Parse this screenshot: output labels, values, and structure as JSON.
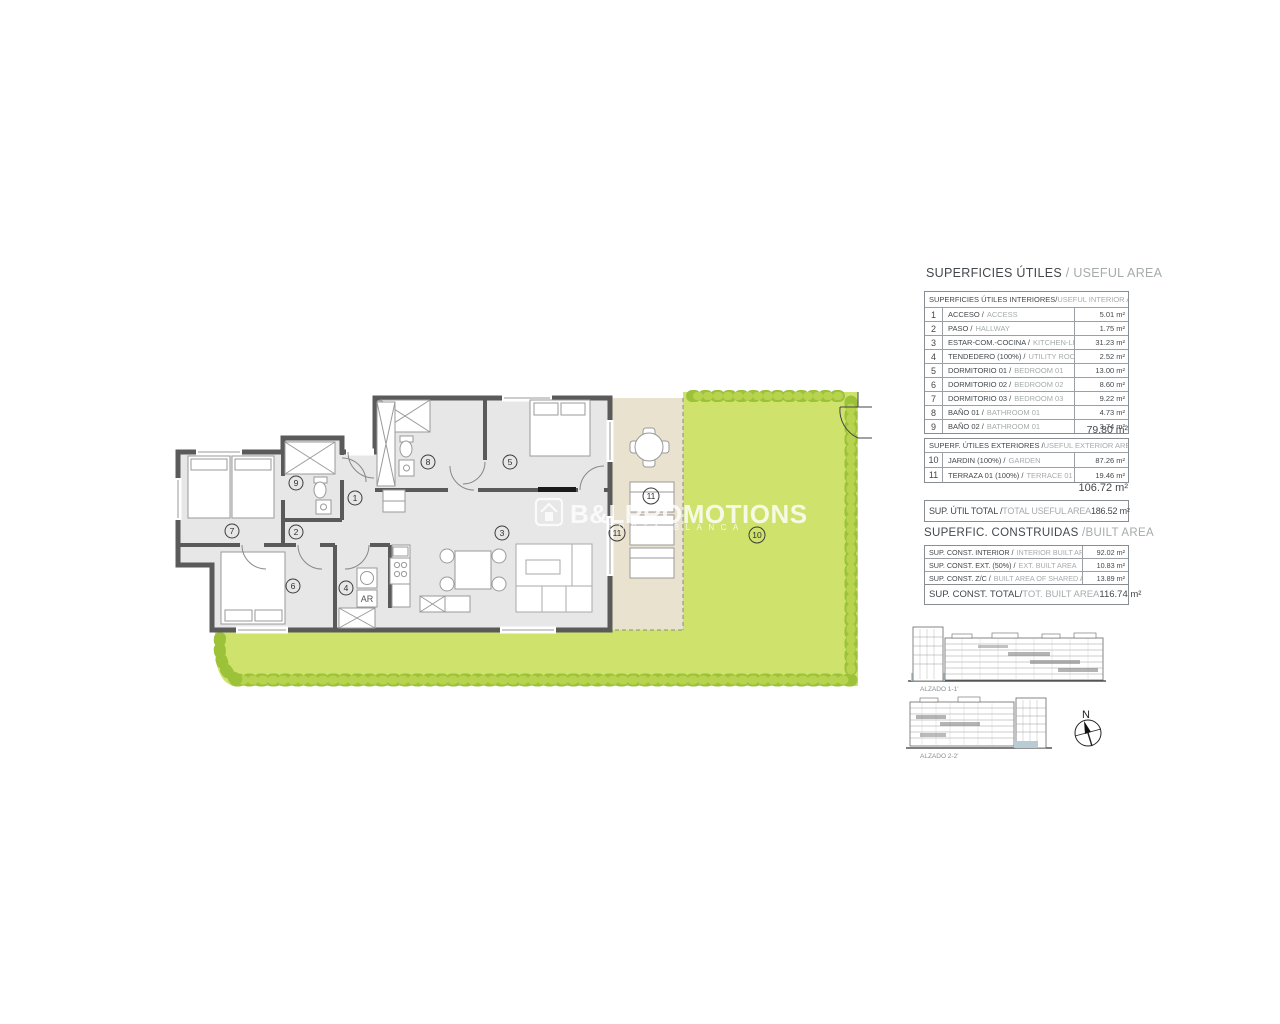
{
  "useful_area": {
    "title_es": "SUPERFICIES ÚTILES",
    "title_en": " / USEFUL AREA",
    "interior": {
      "header_es": "SUPERFICIES ÚTILES INTERIORES/",
      "header_en": " USEFUL INTERIOR AREA",
      "rows": [
        {
          "num": "1",
          "es": "ACCESO /",
          "en": "ACCESS",
          "val": "5.01 m²"
        },
        {
          "num": "2",
          "es": "PASO /",
          "en": "HALLWAY",
          "val": "1.75 m²"
        },
        {
          "num": "3",
          "es": "ESTAR-COM.-COCINA /",
          "en": "KITCHEN-LIVING",
          "val": "31.23 m²"
        },
        {
          "num": "4",
          "es": "TENDEDERO (100%) /",
          "en": "UTILITY ROOM",
          "val": "2.52 m²"
        },
        {
          "num": "5",
          "es": "DORMITORIO 01 /",
          "en": "BEDROOM 01",
          "val": "13.00 m²"
        },
        {
          "num": "6",
          "es": "DORMITORIO 02 /",
          "en": "BEDROOM 02",
          "val": "8.60 m²"
        },
        {
          "num": "7",
          "es": "DORMITORIO 03 /",
          "en": "BEDROOM 03",
          "val": "9.22 m²"
        },
        {
          "num": "8",
          "es": "BAÑO 01 /",
          "en": "BATHROOM 01",
          "val": "4.73 m²"
        },
        {
          "num": "9",
          "es": "BAÑO 02 /",
          "en": "BATHROOM 01",
          "val": "3.74 m²"
        }
      ],
      "subtotal": "79.80 m²"
    },
    "exterior": {
      "header_es": "SUPERF. ÚTILES EXTERIORES /",
      "header_en": " USEFUL EXTERIOR AREA",
      "rows": [
        {
          "num": "10",
          "es": "JARDIN (100%) /",
          "en": "GARDEN",
          "val": "87.26 m²"
        },
        {
          "num": "11",
          "es": "TERRAZA 01 (100%) /",
          "en": "TERRACE 01",
          "val": "19.46 m²"
        }
      ],
      "subtotal": "106.72 m²",
      "total_es": "SUP. ÚTIL TOTAL /",
      "total_en": "TOTAL USEFUL AREA",
      "total_val": "186.52 m²"
    }
  },
  "built_area": {
    "title_es": "SUPERFIC. CONSTRUIDAS ",
    "title_en": "/BUILT AREA",
    "rows": [
      {
        "es": "SUP. CONST. INTERIOR /",
        "en": "INTERIOR BUILT AREA",
        "val": "92.02 m²"
      },
      {
        "es": "SUP. CONST. EXT. (50%) /",
        "en": "EXT. BUILT AREA",
        "val": "10.83 m²"
      },
      {
        "es": "SUP. CONST. Z/C /",
        "en": "BUILT AREA OF SHARED AREAS",
        "val": "13.89 m²"
      }
    ],
    "total_es": "SUP. CONST. TOTAL/",
    "total_en": "TOT. BUILT AREA",
    "total_val": "116.74 m²"
  },
  "plan": {
    "rooms": [
      {
        "n": "1"
      },
      {
        "n": "2"
      },
      {
        "n": "3"
      },
      {
        "n": "4"
      },
      {
        "n": "5"
      },
      {
        "n": "6"
      },
      {
        "n": "7"
      },
      {
        "n": "8"
      },
      {
        "n": "9"
      },
      {
        "n": "10"
      },
      {
        "n": "11"
      }
    ],
    "ar_label": "AR"
  },
  "elevations": {
    "label1": "ALZADO 1-1'",
    "label2": "ALZADO 2-2'"
  },
  "compass": {
    "north": "N"
  },
  "watermark": {
    "brand": "B&LPROMOTIONS",
    "subtitle": "COSTA BLANCA"
  },
  "colors": {
    "garden": "#cfe26b",
    "hedge": "#9cc23a",
    "terrace": "#e9e2cf",
    "wall": "#5a5a5a"
  }
}
